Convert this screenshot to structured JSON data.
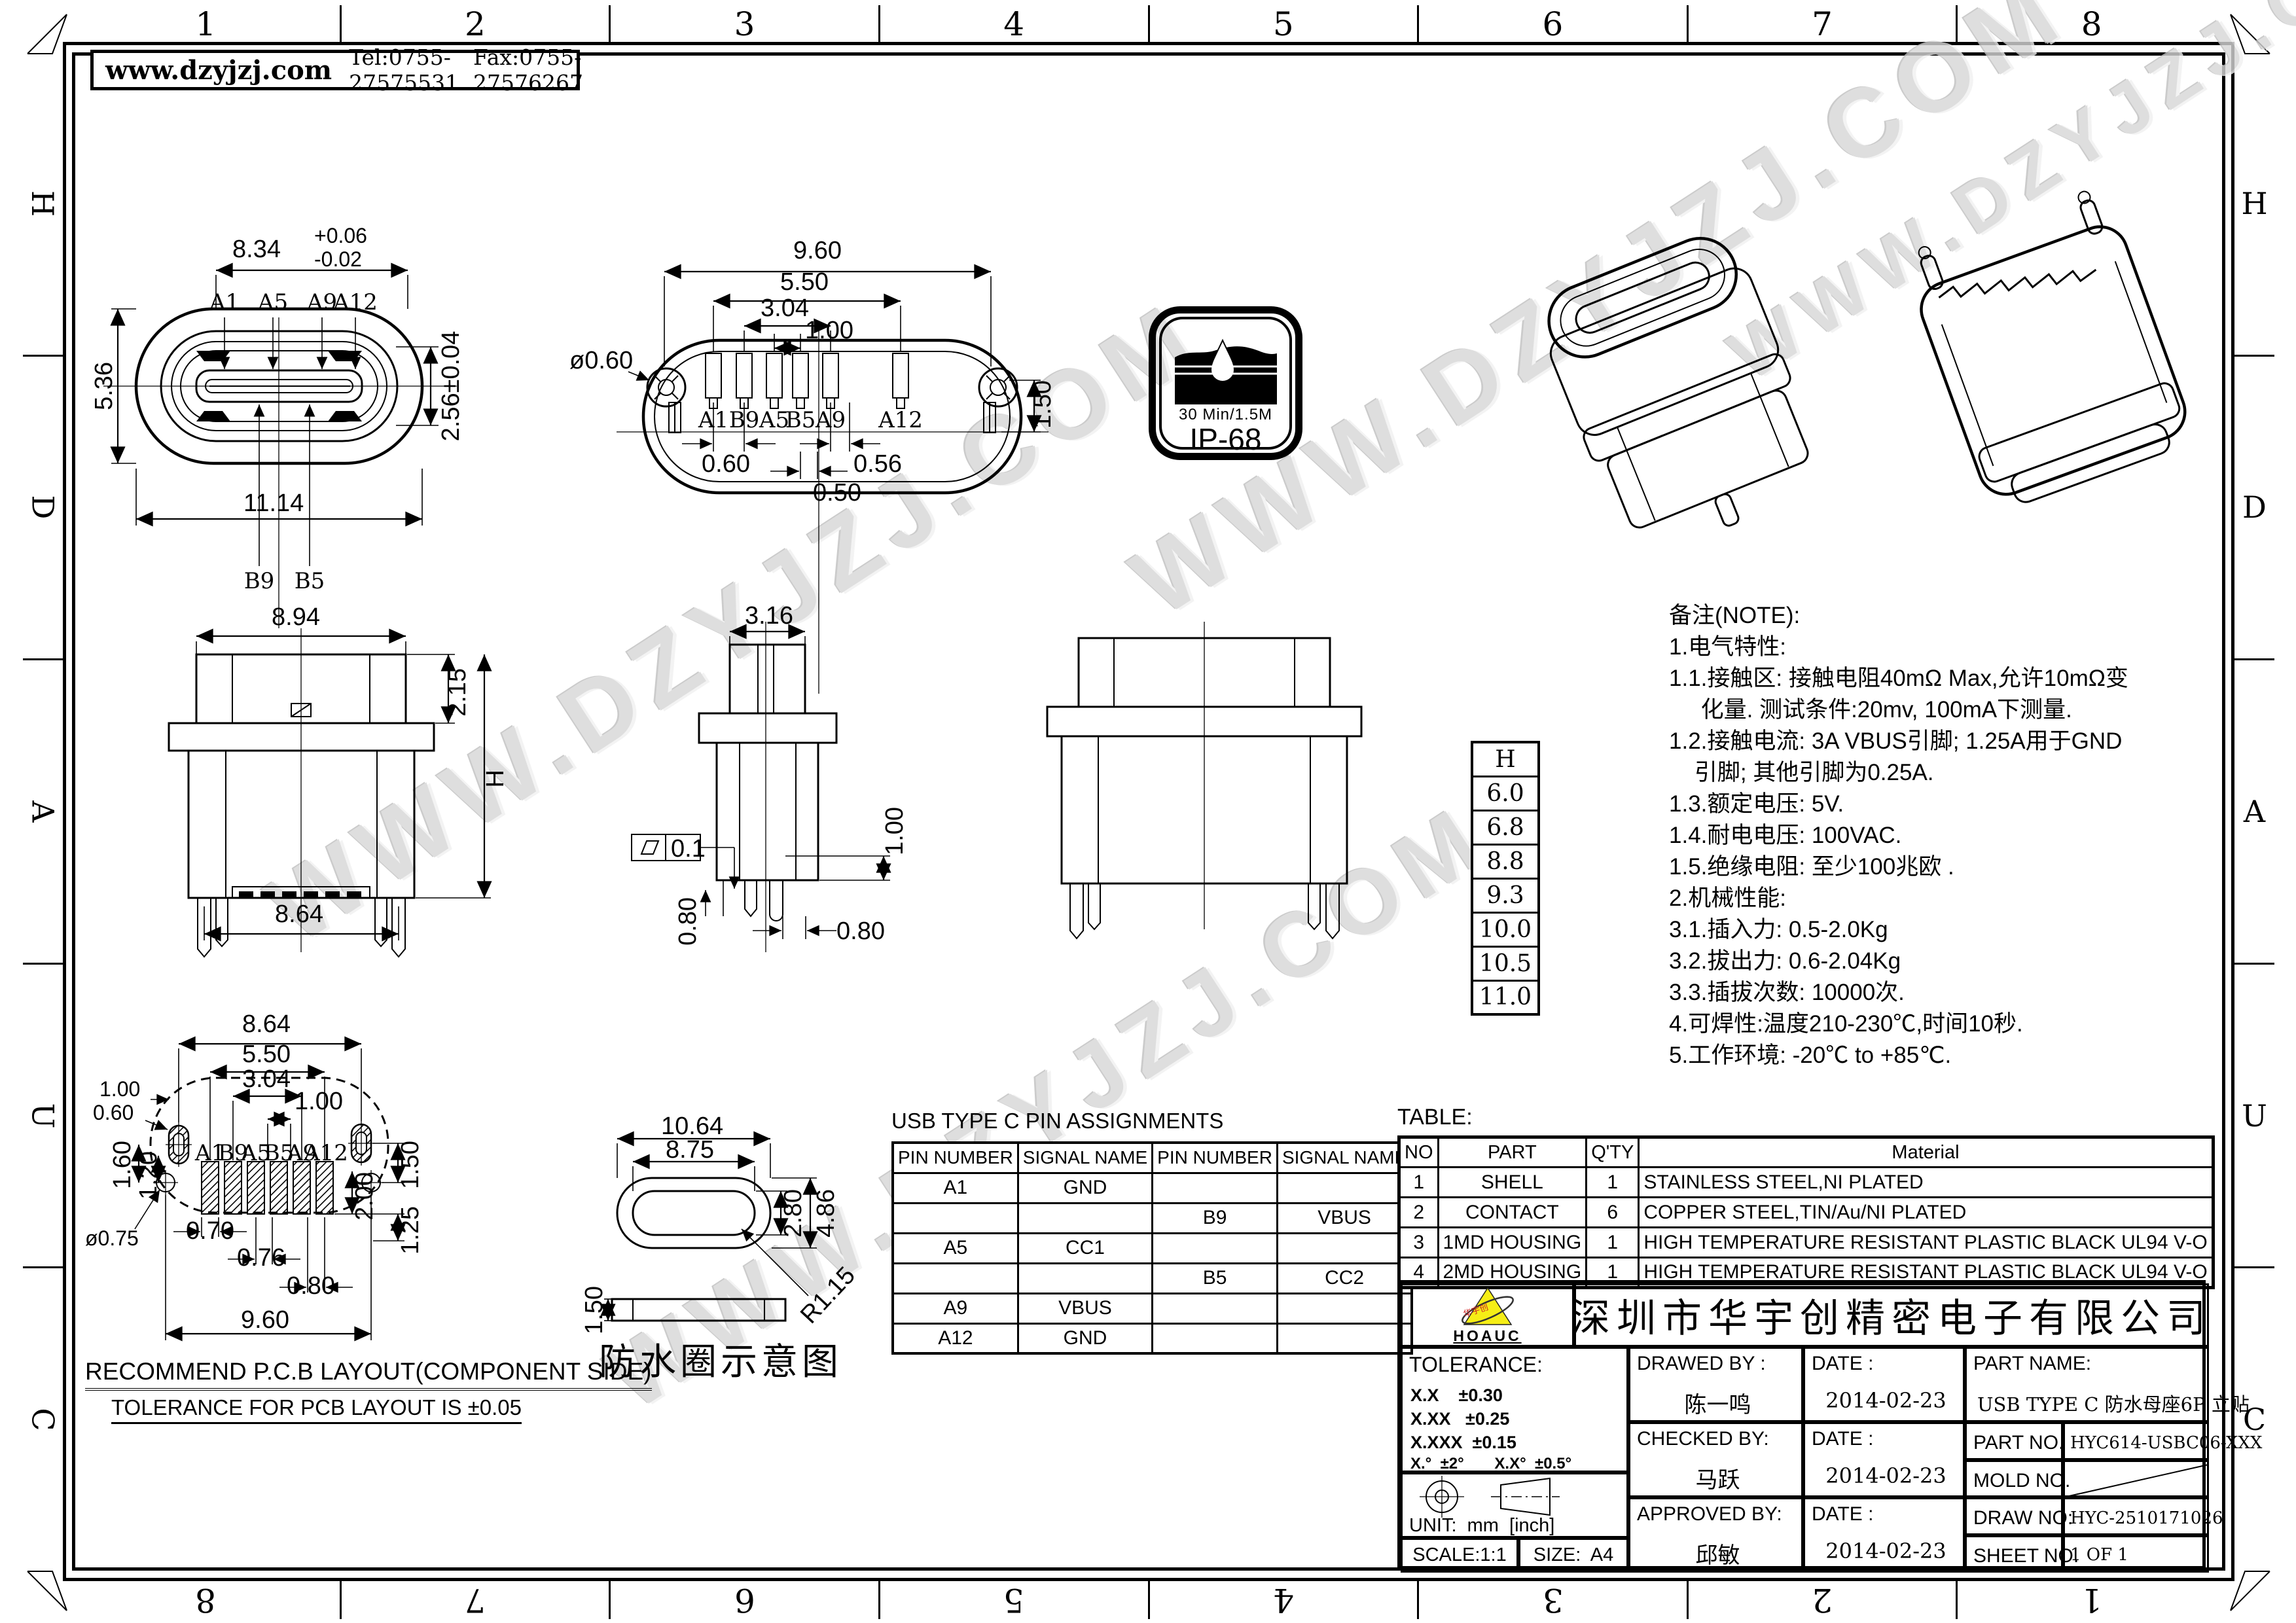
{
  "sheet": {
    "header": {
      "website": "www.dzyjzj.com",
      "tel": "Tel:0755-27575531",
      "fax": "Fax:0755-27576267"
    },
    "zones": {
      "top": [
        "1",
        "2",
        "3",
        "4",
        "5",
        "6",
        "7",
        "8"
      ],
      "bottom": [
        "8",
        "7",
        "6",
        "5",
        "4",
        "3",
        "2",
        "1"
      ],
      "side": [
        "H",
        "D",
        "A",
        "U",
        "C"
      ]
    },
    "watermark": "WWW.DZYJZJ.COM"
  },
  "views": {
    "front": {
      "dim_width": "8.34",
      "dim_tol_up": "+0.06",
      "dim_tol_dn": "-0.02",
      "dim_tongue": "2.56±0.04",
      "dim_height": "5.36",
      "dim_total": "11.14",
      "pin_a1": "A1",
      "pin_a5": "A5",
      "pin_a9": "A9",
      "pin_a12": "A12",
      "pin_b9": "B9",
      "pin_b5": "B5"
    },
    "rear": {
      "dim_w1": "9.60",
      "dim_w2": "5.50",
      "dim_w3": "3.04",
      "dim_w4": "1.00",
      "dim_hole": "ø0.60",
      "dim_h": "1.50",
      "dim_p1": "0.60",
      "dim_p2": "0.56",
      "dim_p3": "0.50",
      "pins": [
        "A1",
        "B9",
        "A5",
        "B5",
        "A9",
        "A12"
      ]
    },
    "ip68": {
      "line1": "30 Min/1.5M",
      "line2": "IP-68"
    },
    "side": {
      "dim_top": "8.94",
      "dim_step": "2.15",
      "dim_h": "H",
      "dim_bottom": "8.64"
    },
    "mid": {
      "dim_top": "3.16",
      "flatness": "0.1",
      "dim_right": "1.00",
      "dim_left": "0.80",
      "dim_bottom": "0.80"
    },
    "h_table": {
      "header": "H",
      "values": [
        "6.0",
        "6.8",
        "8.8",
        "9.3",
        "10.0",
        "10.5",
        "11.0"
      ]
    },
    "pcb": {
      "dim_t1": "8.64",
      "dim_t2": "5.50",
      "dim_t3": "3.04",
      "dim_t4": "1.00",
      "dim_l1": "1.00",
      "dim_l2": "0.60",
      "dim_l3": "1.60",
      "dim_l4": "1.20",
      "dim_hole": "ø0.75",
      "dim_r1": "1.50",
      "dim_r2": "2.00",
      "dim_r3": "1.25",
      "dim_b1": "0.70",
      "dim_b2": "0.76",
      "dim_b3": "0.80",
      "dim_b4": "9.60",
      "pins": [
        "A1",
        "B9",
        "A5",
        "B5",
        "A9",
        "A12"
      ],
      "caption1": "RECOMMEND P.C.B LAYOUT(COMPONENT SIDE)",
      "caption2": "TOLERANCE FOR PCB LAYOUT IS ±0.05"
    },
    "gasket": {
      "dim_w1": "10.64",
      "dim_w2": "8.75",
      "dim_h1": "2.80",
      "dim_h2": "4.86",
      "dim_r": "R1.15",
      "dim_t": "1.50",
      "caption": "防水圈示意图"
    }
  },
  "notes": {
    "lines": [
      "备注(NOTE):",
      "1.电气特性:",
      "1.1.接触区: 接触电阻40mΩ Max,允许10mΩ变",
      "     化量. 测试条件:20mv, 100mA下测量.",
      "1.2.接触电流: 3A VBUS引脚; 1.25A用于GND",
      "    引脚; 其他引脚为0.25A.",
      "1.3.额定电压: 5V.",
      "1.4.耐电电压: 100VAC.",
      "1.5.绝缘电阻: 至少100兆欧 .",
      "2.机械性能:",
      "3.1.插入力: 0.5-2.0Kg",
      "3.2.拔出力: 0.6-2.04Kg",
      "3.3.插拔次数: 10000次.",
      "4.可焊性:温度210-230℃,时间10秒.",
      "5.工作环境: -20℃ to +85℃."
    ]
  },
  "pin_table": {
    "title": "USB TYPE C PIN ASSIGNMENTS",
    "headers": [
      "PIN NUMBER",
      "SIGNAL NAME",
      "PIN NUMBER",
      "SIGNAL NAME"
    ],
    "rows": [
      [
        "A1",
        "GND",
        "",
        ""
      ],
      [
        "",
        "",
        "B9",
        "VBUS"
      ],
      [
        "A5",
        "CC1",
        "",
        ""
      ],
      [
        "",
        "",
        "B5",
        "CC2"
      ],
      [
        "A9",
        "VBUS",
        "",
        ""
      ],
      [
        "A12",
        "GND",
        "",
        ""
      ]
    ]
  },
  "parts_table": {
    "label": "TABLE:",
    "headers": [
      "NO",
      "PART",
      "Q'TY",
      "Material"
    ],
    "rows": [
      [
        "1",
        "SHELL",
        "1",
        "STAINLESS STEEL,NI PLATED"
      ],
      [
        "2",
        "CONTACT",
        "6",
        "COPPER STEEL,TIN/Au/NI PLATED"
      ],
      [
        "3",
        "1MD HOUSING",
        "1",
        "HIGH TEMPERATURE RESISTANT PLASTIC BLACK UL94 V-O"
      ],
      [
        "4",
        "2MD HOUSING",
        "1",
        "HIGH TEMPERATURE RESISTANT PLASTIC BLACK UL94 V-O"
      ]
    ]
  },
  "title_block": {
    "company": "深圳市华宇创精密电子有限公司",
    "logo_text": "HOAUC",
    "logo_mark": "华宇创",
    "tolerance": {
      "label": "TOLERANCE:",
      "rows": [
        "X.X    ±0.30",
        "X.XX   ±0.25",
        "X.XXX  ±0.15"
      ],
      "angles": "X.°  ±2°       X.X°  ±0.5°"
    },
    "unit": "UNIT:  mm  [inch]",
    "scale": "SCALE:1:1",
    "size": "SIZE:  A4",
    "drawed": {
      "label": "DRAWED BY :",
      "name": "陈一鸣",
      "date_label": "DATE :",
      "date": "2014-02-23"
    },
    "checked": {
      "label": "CHECKED BY:",
      "name": "马跃",
      "date_label": "DATE :",
      "date": "2014-02-23"
    },
    "approved": {
      "label": "APPROVED BY:",
      "name": "邱敏",
      "date_label": "DATE :",
      "date": "2014-02-23"
    },
    "part_name": {
      "label": "PART NAME:",
      "value": "USB TYPE C 防水母座6P 立贴"
    },
    "part_no": {
      "label": "PART NO.",
      "value": "HYC614-USBC06-XXX"
    },
    "mold_no": {
      "label": "MOLD NO.",
      "value": ""
    },
    "draw_no": {
      "label": "DRAW NO:",
      "value": "HYC-2510171026"
    },
    "sheet_no": {
      "label": "SHEET NO.",
      "value": "1 OF 1"
    }
  },
  "colors": {
    "line": "#000000",
    "logo_yellow": "#f6ee16",
    "watermark": "#d7d7d7"
  }
}
